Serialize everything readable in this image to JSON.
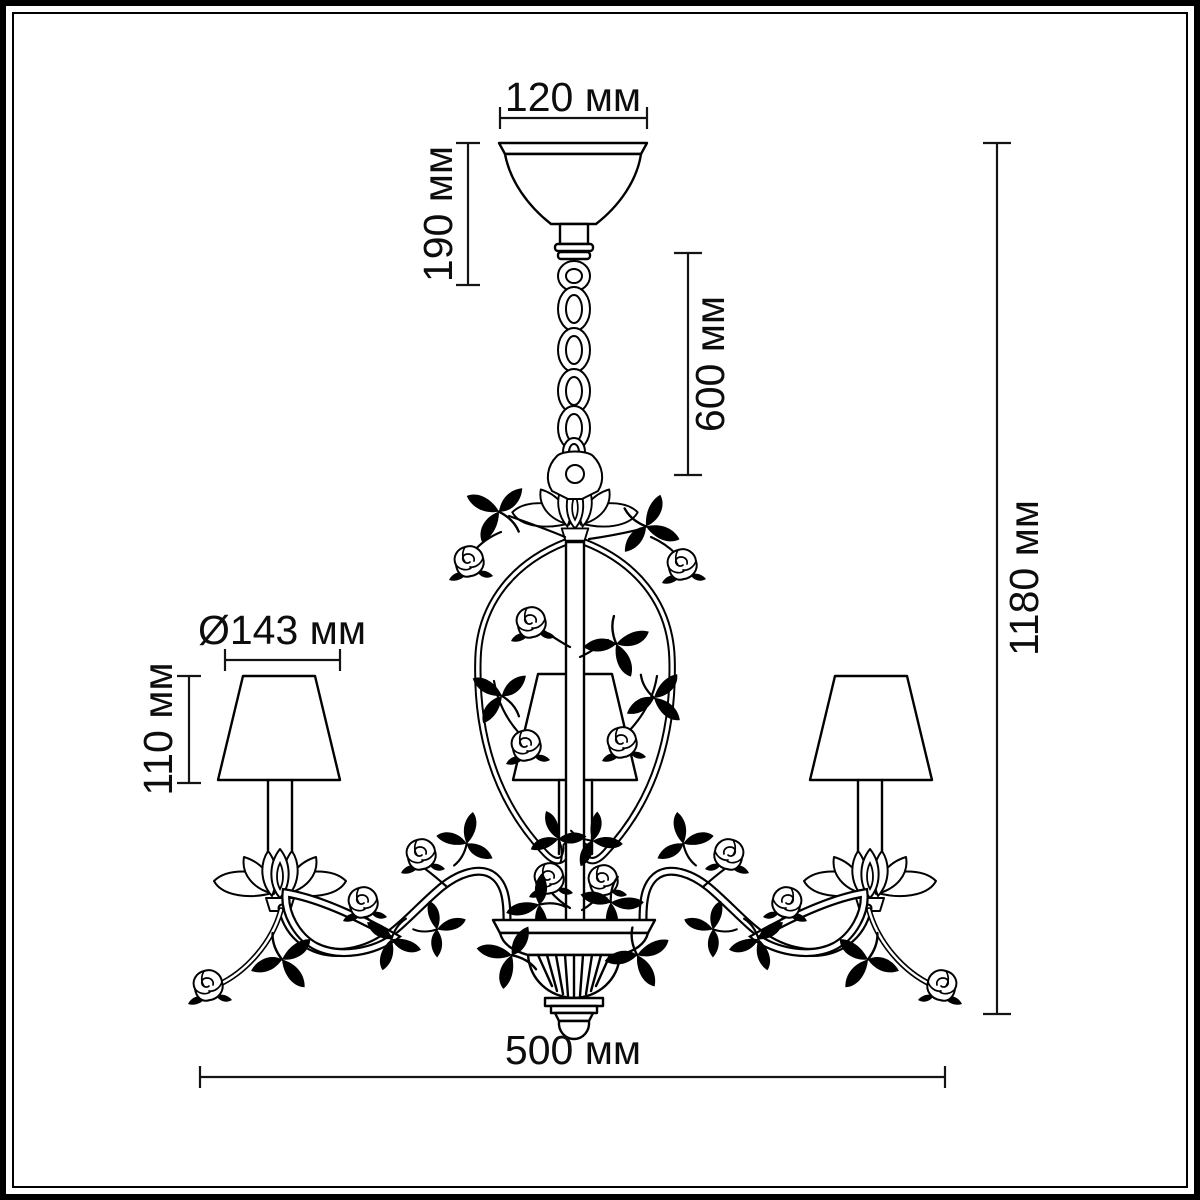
{
  "diagram": {
    "kind": "chandelier-dimension-drawing",
    "colors": {
      "line": "#000000",
      "background": "#ffffff",
      "dimension": "#141414"
    },
    "dimensions": {
      "canopy_width": "120 мм",
      "canopy_height": "190 мм",
      "chain_length": "600 мм",
      "total_height": "1180 мм",
      "shade_diameter": "Ø143 мм",
      "shade_height": "110 мм",
      "total_width": "500 мм"
    }
  }
}
